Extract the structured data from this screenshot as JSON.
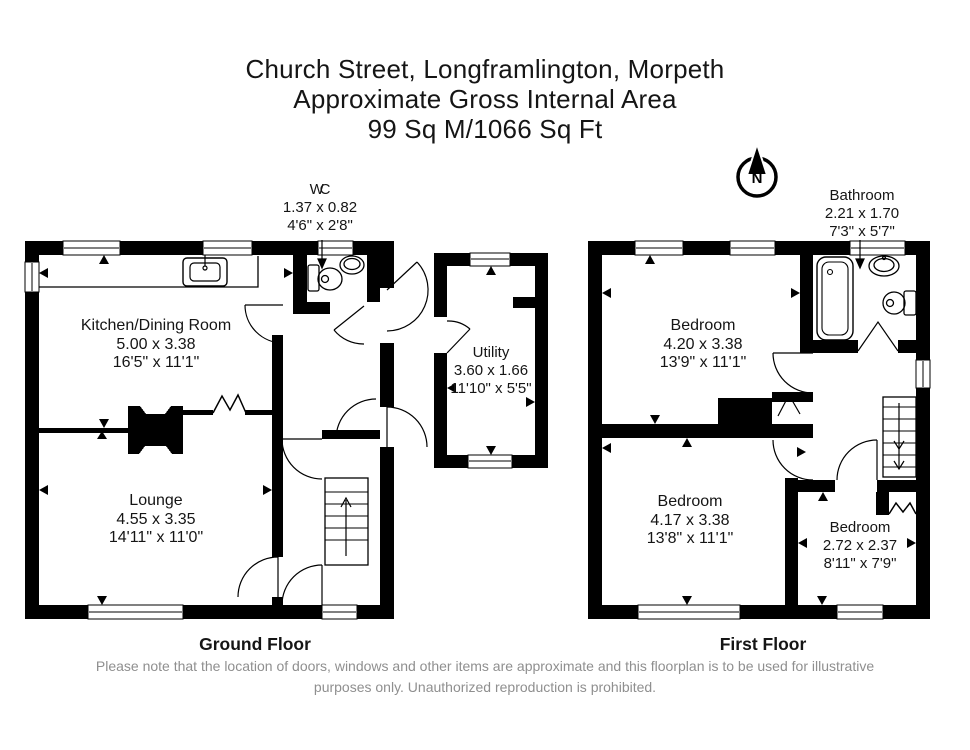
{
  "title": {
    "line1": "Church Street, Longframlington, Morpeth",
    "line2": "Approximate Gross Internal Area",
    "line3": "99 Sq M/1066 Sq Ft"
  },
  "compass": {
    "north_label": "N"
  },
  "ground_floor": {
    "label": "Ground Floor",
    "wc": {
      "name": "WC",
      "metric": "1.37 x 0.82",
      "imperial": "4'6\" x 2'8\""
    },
    "kitchen": {
      "name": "Kitchen/Dining Room",
      "metric": "5.00 x 3.38",
      "imperial": "16'5\" x 11'1\""
    },
    "lounge": {
      "name": "Lounge",
      "metric": "4.55 x 3.35",
      "imperial": "14'11\" x 11'0\""
    },
    "utility": {
      "name": "Utility",
      "metric": "3.60 x 1.66",
      "imperial": "11'10\" x 5'5\""
    }
  },
  "first_floor": {
    "label": "First Floor",
    "bathroom": {
      "name": "Bathroom",
      "metric": "2.21 x 1.70",
      "imperial": "7'3\" x 5'7\""
    },
    "bedroom1": {
      "name": "Bedroom",
      "metric": "4.20 x 3.38",
      "imperial": "13'9\" x 11'1\""
    },
    "bedroom2": {
      "name": "Bedroom",
      "metric": "4.17 x 3.38",
      "imperial": "13'8\" x 11'1\""
    },
    "bedroom3": {
      "name": "Bedroom",
      "metric": "2.72 x 2.37",
      "imperial": "8'11\" x 7'9\""
    }
  },
  "disclaimer": {
    "line1": "Please note that the location of doors, windows and other items are approximate and this floorplan is to be used for illustrative",
    "line2": "purposes only. Unauthorized reproduction is prohibited."
  },
  "colors": {
    "wall": "#000000",
    "text": "#151515",
    "disclaimer_text": "#8f8f8f",
    "background": "#ffffff"
  }
}
